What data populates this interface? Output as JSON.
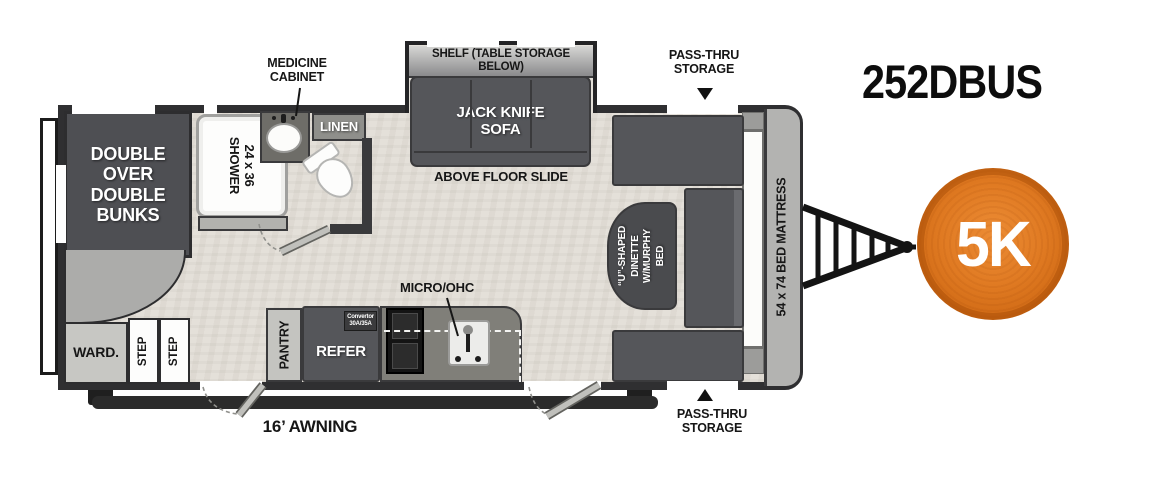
{
  "title": "252DBUS",
  "badge": {
    "label": "5K",
    "color": "#dd7420"
  },
  "colors": {
    "wall": "#2f2f31",
    "furniture": "#55565a",
    "floor": "#e4e0d9",
    "cap": "#b3b3b1",
    "accent": "#dd7420"
  },
  "callouts": {
    "medicine_cabinet": "MEDICINE\nCABINET",
    "pass_thru_top": "PASS-THRU\nSTORAGE",
    "pass_thru_bottom": "PASS-THRU\nSTORAGE",
    "micro_ohc": "MICRO/OHC",
    "above_floor_slide": "ABOVE FLOOR SLIDE",
    "awning": "16’ AWNING"
  },
  "rooms": {
    "shelf": "SHELF (TABLE STORAGE BELOW)",
    "sofa": "JACK KNIFE\nSOFA",
    "bunks": "DOUBLE\nOVER\nDOUBLE\nBUNKS",
    "shower": "24 x 36\nSHOWER",
    "linen": "LINEN",
    "wardrobe": "WARD.",
    "step_left": "STEP",
    "step_right": "STEP",
    "pantry": "PANTRY",
    "refer": "REFER",
    "convertor": "Convertor\n30A/35A",
    "dinette": "“U”-SHAPED\nDINETTE\nW/MURPHY BED",
    "bed_mattress": "54 x 74 BED MATTRESS"
  }
}
